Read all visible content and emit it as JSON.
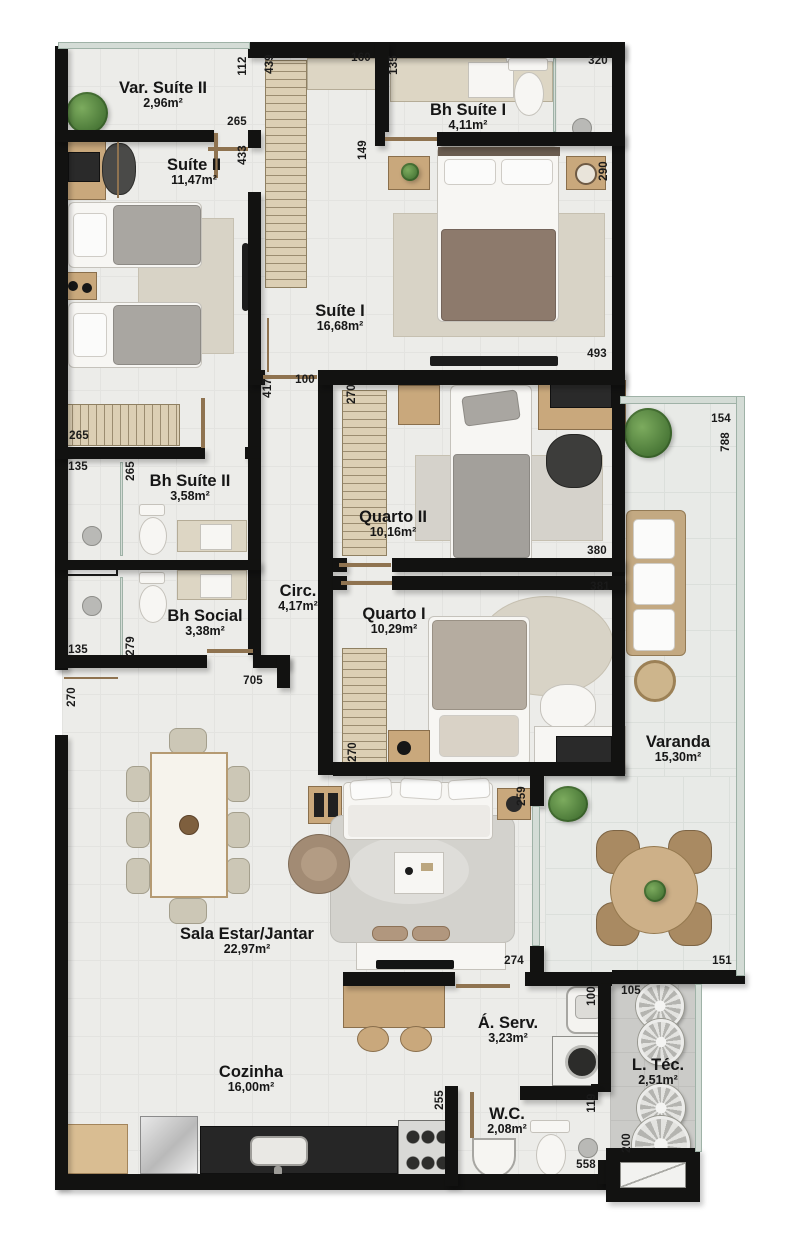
{
  "plan_title": "Apartment floor plan",
  "colors": {
    "wall": "#121211",
    "floor": "#ecece9",
    "floor_technical": "#cbcbc8",
    "varanda_glass": "#9fb2a7",
    "wood": "#c9a87c",
    "label_text": "#161616"
  },
  "rooms": [
    {
      "name": "Var. Suíte II",
      "area": "2,96m²"
    },
    {
      "name": "Suíte II",
      "area": "11,47m²"
    },
    {
      "name": "Bh Suíte I",
      "area": "4,11m²"
    },
    {
      "name": "Suíte I",
      "area": "16,68m²"
    },
    {
      "name": "Quarto II",
      "area": "10,16m²"
    },
    {
      "name": "Bh Suíte II",
      "area": "3,58m²"
    },
    {
      "name": "Bh Social",
      "area": "3,38m²"
    },
    {
      "name": "Circ.",
      "area": "4,17m²"
    },
    {
      "name": "Quarto I",
      "area": "10,29m²"
    },
    {
      "name": "Varanda",
      "area": "15,30m²"
    },
    {
      "name": "Sala Estar/Jantar",
      "area": "22,97m²"
    },
    {
      "name": "Cozinha",
      "area": "16,00m²"
    },
    {
      "name": "Á. Serv.",
      "area": "3,23m²"
    },
    {
      "name": "L. Téc.",
      "area": "2,51m²"
    },
    {
      "name": "W.C.",
      "area": "2,08m²"
    }
  ],
  "dims": [
    "112",
    "265",
    "439",
    "160",
    "135",
    "320",
    "433",
    "149",
    "290",
    "493",
    "417",
    "100",
    "270",
    "154",
    "788",
    "380",
    "381",
    "265",
    "135",
    "265",
    "135",
    "279",
    "705",
    "270",
    "270",
    "259",
    "274",
    "151",
    "100",
    "105",
    "119",
    "255",
    "200",
    "558"
  ]
}
